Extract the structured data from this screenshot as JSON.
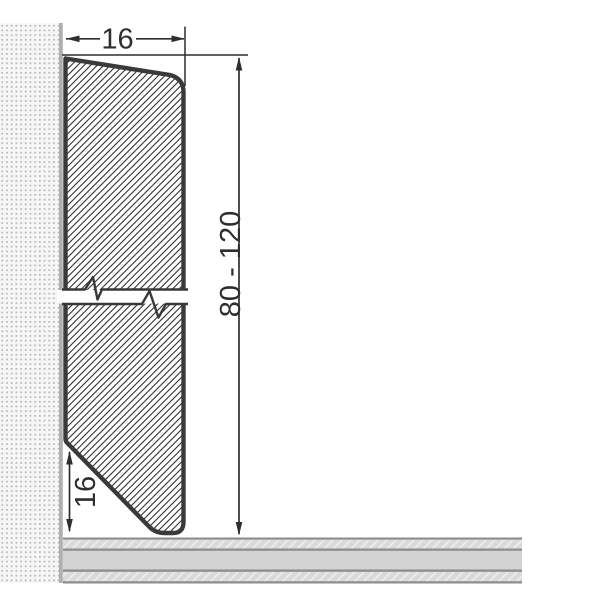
{
  "diagram": {
    "type": "technical-drawing",
    "subject": "Skirting board profile cross-section mounted on wall above floor",
    "labels": {
      "top_width": "16",
      "height_range": "80 - 120",
      "bottom_bevel": "16"
    },
    "colors": {
      "background": "#ffffff",
      "profile_outline": "#3a3a3a",
      "hatch_line": "#303030",
      "dimension_ink": "#2e2e2e",
      "wall_fill": "#f6f6f6",
      "wall_dot": "#b5b5b5",
      "wall_edge_line": "#b0b0b0",
      "floor_border": "#8d8d8d",
      "floor_band_plain": "#d3d3d3",
      "floor_band_hatched": "#dadada"
    }
  }
}
